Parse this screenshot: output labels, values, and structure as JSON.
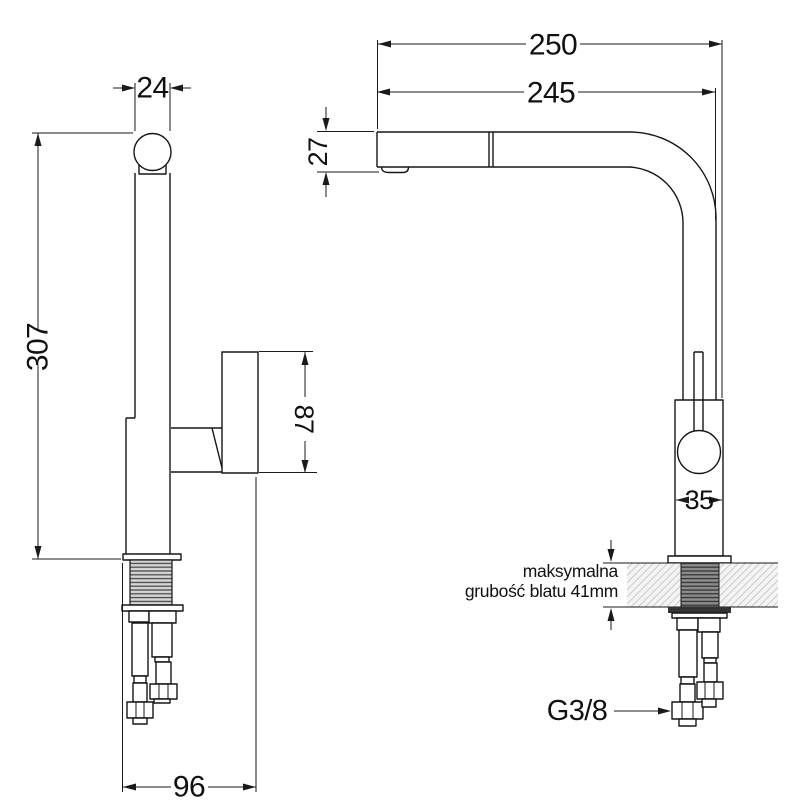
{
  "drawing": {
    "type": "faucet-technical-dimension-drawing",
    "dims": {
      "spout_pipe_diameter": "24",
      "total_height": "307",
      "reach_overall": "250",
      "reach_spout": "245",
      "spout_end_height": "27",
      "lever_length": "87",
      "body_width": "35",
      "base_depth": "96",
      "hose_thread": "G3/8"
    },
    "notes": {
      "counter_note_line1": "maksymalna",
      "counter_note_line2": "grubość blatu 41mm"
    },
    "colors": {
      "line": "#161616",
      "hatch": "#b9b9b9",
      "thread_light_bg": "#d6d6d6",
      "thread_dark_bg": "#8d8d8d"
    }
  }
}
